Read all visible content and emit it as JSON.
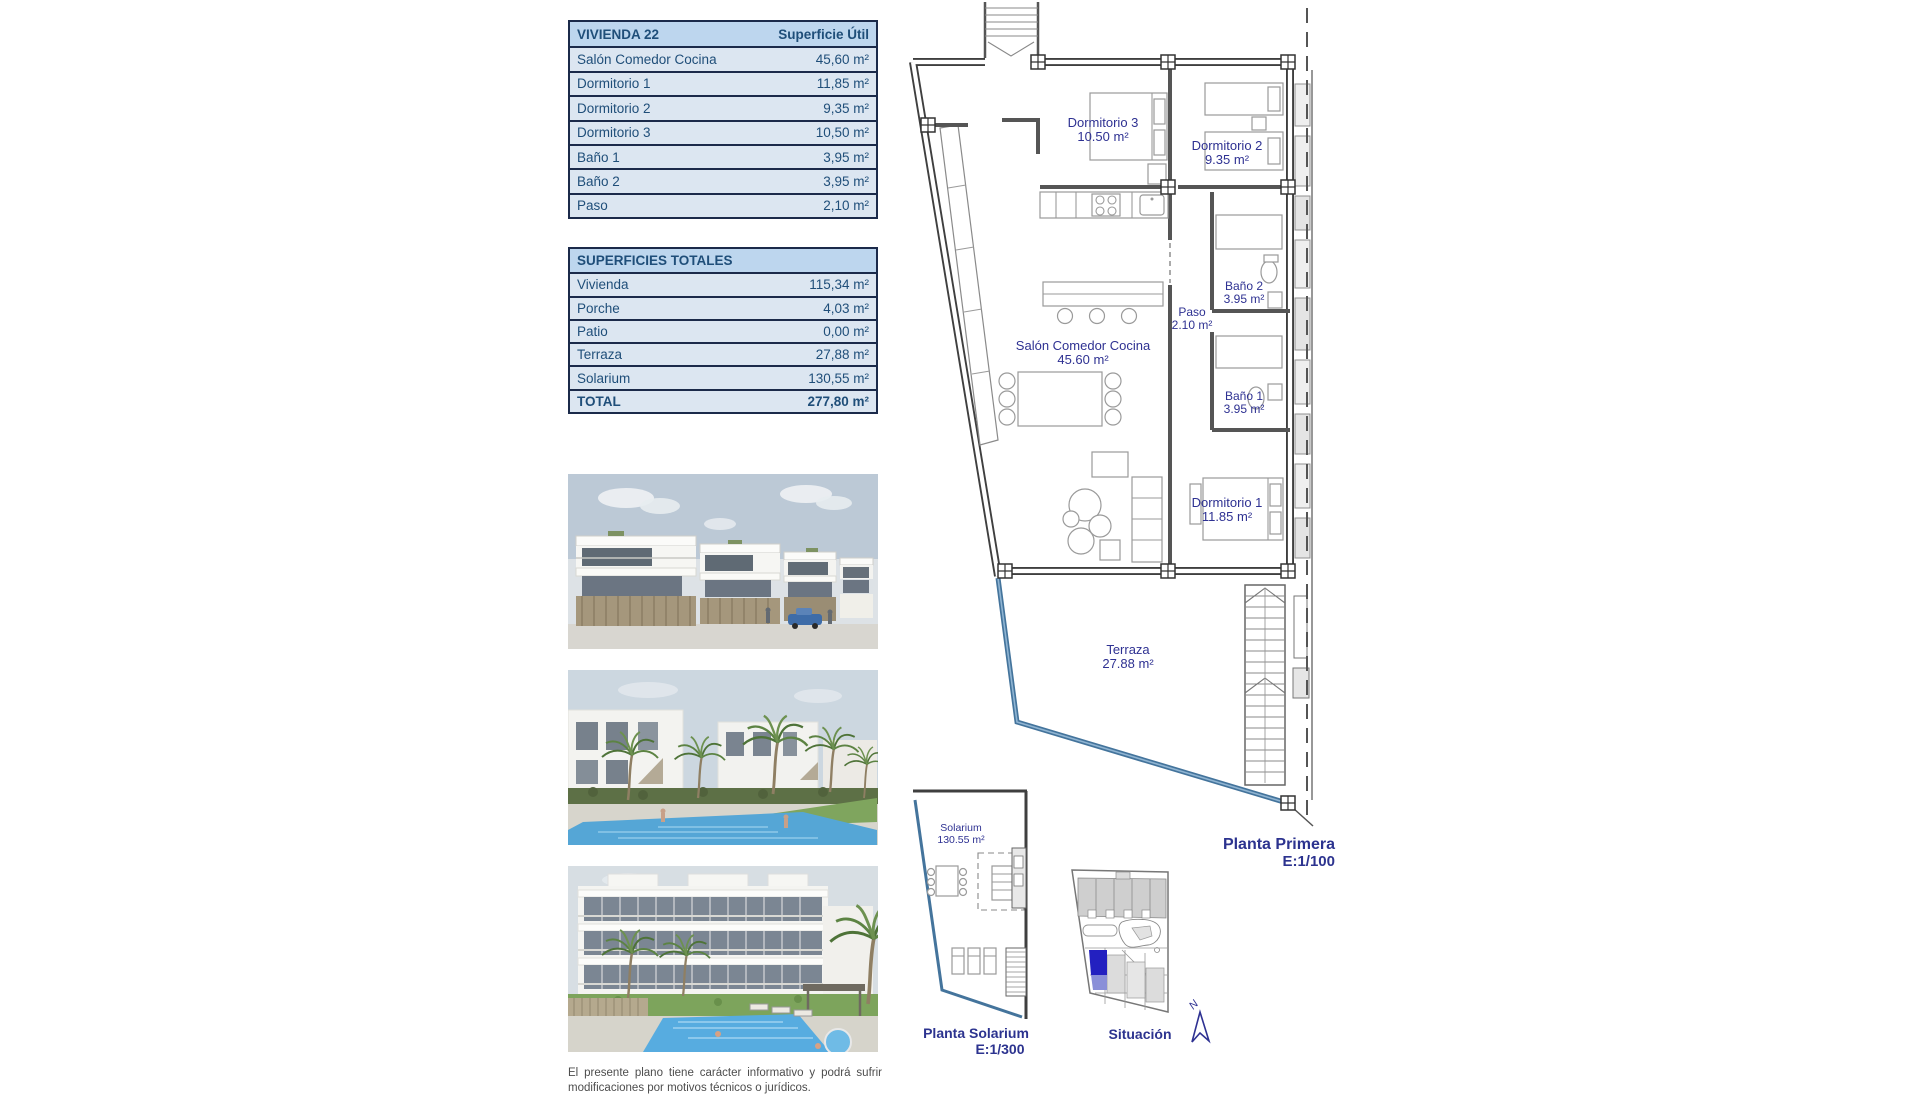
{
  "tables": {
    "vivienda": {
      "title": "VIVIENDA 22",
      "col_header": "Superficie Útil",
      "rows": [
        [
          "Salón Comedor Cocina",
          "45,60 m²"
        ],
        [
          "Dormitorio 1",
          "11,85 m²"
        ],
        [
          "Dormitorio 2",
          "9,35 m²"
        ],
        [
          "Dormitorio 3",
          "10,50 m²"
        ],
        [
          "Baño 1",
          "3,95 m²"
        ],
        [
          "Baño 2",
          "3,95 m²"
        ],
        [
          "Paso",
          "2,10 m²"
        ]
      ]
    },
    "totales": {
      "title": "SUPERFICIES TOTALES",
      "rows": [
        [
          "Vivienda",
          "115,34 m²"
        ],
        [
          "Porche",
          "4,03 m²"
        ],
        [
          "Patio",
          "0,00 m²"
        ],
        [
          "Terraza",
          "27,88 m²"
        ],
        [
          "Solarium",
          "130,55 m²"
        ]
      ],
      "total_label": "TOTAL",
      "total_value": "277,80 m²"
    }
  },
  "plan": {
    "rooms": {
      "dormitorio3": {
        "name": "Dormitorio 3",
        "area": "10.50 m²"
      },
      "dormitorio2": {
        "name": "Dormitorio 2",
        "area": "9.35 m²"
      },
      "salon": {
        "name": "Salón Comedor Cocina",
        "area": "45.60 m²"
      },
      "paso": {
        "name": "Paso",
        "area": "2.10 m²"
      },
      "bano2": {
        "name": "Baño 2",
        "area": "3.95 m²"
      },
      "bano1": {
        "name": "Baño 1",
        "area": "3.95 m²"
      },
      "dormitorio1": {
        "name": "Dormitorio 1",
        "area": "11.85 m²"
      },
      "terraza": {
        "name": "Terraza",
        "area": "27.88 m²"
      },
      "solarium": {
        "name": "Solarium",
        "area": "130.55 m²"
      }
    },
    "captions": {
      "planta_primera": "Planta Primera",
      "planta_primera_scale": "E:1/100",
      "planta_solarium": "Planta Solarium",
      "planta_solarium_scale": "E:1/300",
      "situacion": "Situación",
      "north": "N"
    }
  },
  "disclaimer": "El presente plano tiene carácter informativo y podrá sufrir modificaciones por motivos técnicos o jurídicos.",
  "colors": {
    "accent_navy": "#2e3192",
    "table_text": "#1f4e79",
    "table_header_bg": "#bdd6ee",
    "table_row_bg": "#dce6f1",
    "terrace_line": "#44749c",
    "situacion_highlight": "#2320c0"
  }
}
